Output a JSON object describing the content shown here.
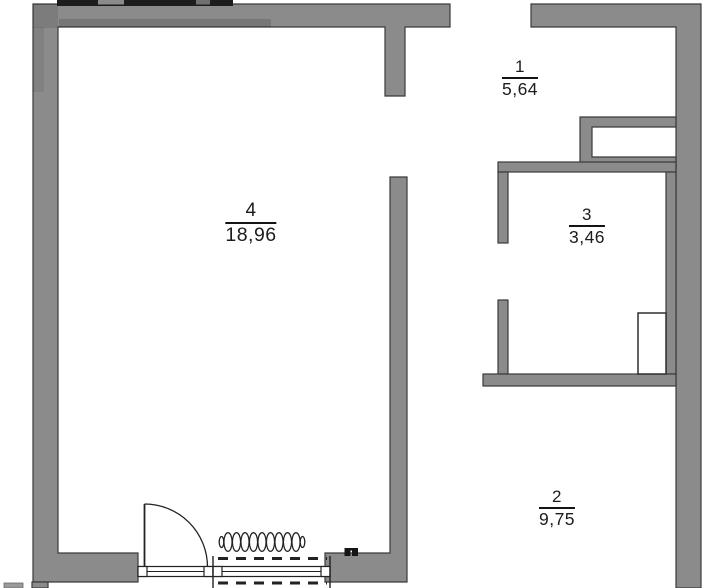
{
  "plan": {
    "title": "apartment-floor-plan",
    "rooms": [
      {
        "number": "4",
        "area": "18,96"
      },
      {
        "number": "1",
        "area": "5,64"
      },
      {
        "number": "3",
        "area": "3,46"
      },
      {
        "number": "2",
        "area": "9,75"
      }
    ]
  },
  "colors": {
    "wall": "#8b8b8b",
    "outline": "#3a3a3a",
    "text": "#1c1c1c",
    "background": "#ffffff"
  },
  "symbols": {
    "door": "door-swing",
    "radiator": "radiator-coil",
    "window": "window-sill",
    "socket": "socket-mark",
    "shaft": "vent-shaft"
  }
}
